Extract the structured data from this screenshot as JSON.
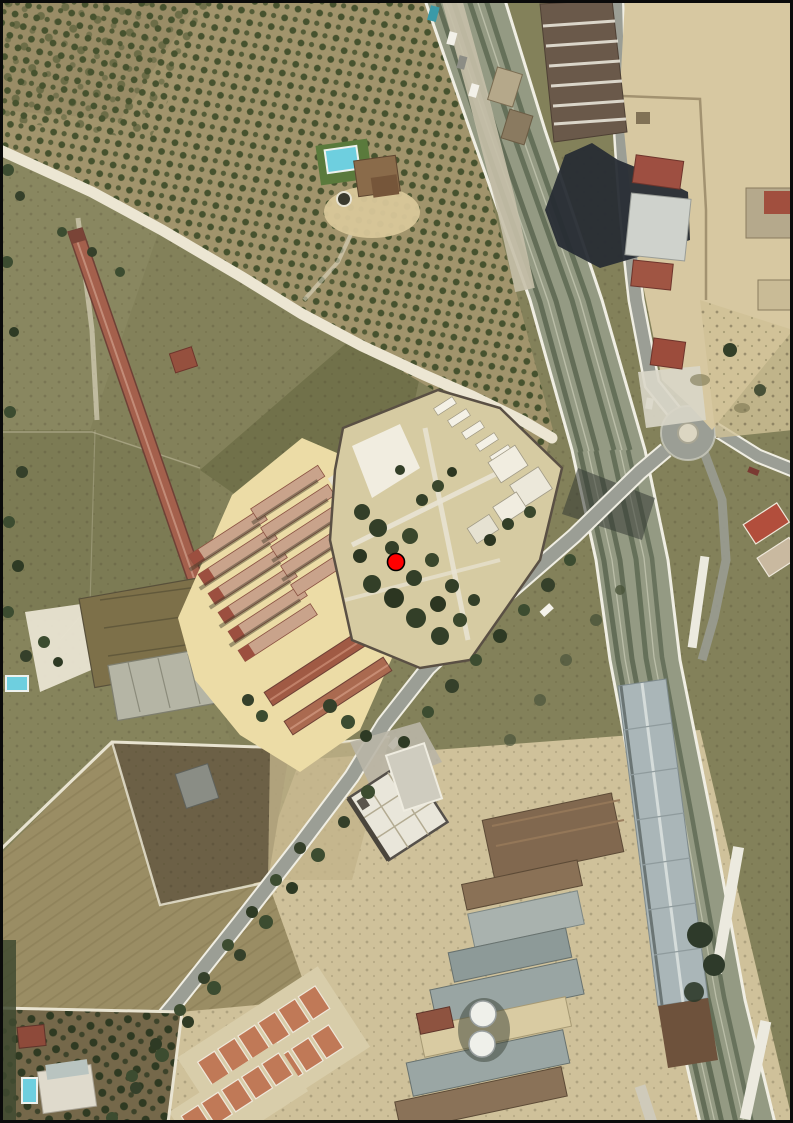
{
  "canvas": {
    "width": 793,
    "height": 1123,
    "kind": "aerial-orthophoto"
  },
  "marker": {
    "x": 396,
    "y": 562,
    "radius": 8.5,
    "color": "#ff0000",
    "outline": "#000000"
  },
  "palette": {
    "marker-red": "#ff0000",
    "marker-outline": "#000000",
    "orchard-ground": "#a1946c",
    "orchard-tree": "#46522e",
    "scrub-field": "#83815a",
    "plowed-field": "#9a8d64",
    "dirt-path": "#ece6d3",
    "road-gray": "#9b9e95",
    "road-edge": "#f0eee3",
    "rail-ballast": "#949a83",
    "rail-track": "#5d6852",
    "tan-dirt": "#d7c8a1",
    "farm-pad": "#ecdca6",
    "farm-roof": "#c9a38b",
    "farm-roof-edge": "#8a5242",
    "red-building": "#a4604c",
    "cemetery-ground": "#d6cba2",
    "cemetery-white": "#f1ede0",
    "cypress-green": "#333f28",
    "pool-blue": "#6ecfdf",
    "lawn-green": "#5a7a3c",
    "warehouse-gray": "#aab6b8",
    "industrial-brown": "#81684f",
    "rowhouse-terracotta": "#c07957",
    "shadow-dark": "#272c34",
    "bare-white": "#e9e4d2",
    "border-black": "#0a0a0a"
  }
}
